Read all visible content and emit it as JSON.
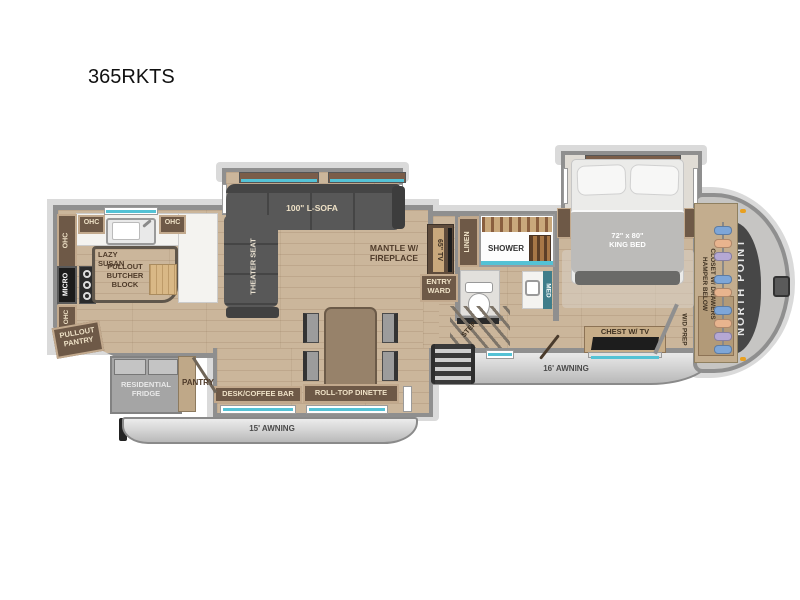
{
  "labels": {
    "model": "365RKTS",
    "ohc": "OHC",
    "micro": "MICRO",
    "lazy_susan": "LAZY\nSUSAN",
    "pullout_butcher_block": "PULLOUT\nBUTCHER\nBLOCK",
    "pullout_pantry": "PULLOUT\nPANTRY",
    "residential_fridge": "RESIDENTIAL\nFRIDGE",
    "pantry": "PANTRY",
    "desk_coffee_bar": "DESK/COFFEE BAR",
    "roll_top_dinette": "ROLL-TOP DINETTE",
    "awning_15": "15' AWNING",
    "awning_16": "16' AWNING",
    "l_sofa": "100\" L-SOFA",
    "theater_seat": "THEATER SEAT",
    "mantle_fireplace": "MANTLE W/\nFIREPLACE",
    "tv_65": "65\" TV",
    "linen": "LINEN",
    "shower": "SHOWER",
    "entry_ward": "ENTRY\nWARD",
    "med": "MED",
    "step": "STEP",
    "chest_tv": "CHEST W/ TV",
    "wd_prep": "W/D PREP",
    "king_bed": "72\" x 80\"\nKING BED",
    "closet": "CLOSET W/ DRAWERS\nHAMPER BELOW",
    "north_point": "NORTH POINT"
  },
  "colors": {
    "floor_wood": "#cbb69b",
    "cabinet_brown": "#6e5947",
    "cabinet_trim": "#c2a98d",
    "glass_accent": "#54c2d5",
    "sofa_dark": "#565656",
    "wall_gray": "#8f8f8f",
    "awning_gray": "#d6d6d6",
    "front_cap_dark": "#474747",
    "marker_light": "#e8a020"
  }
}
